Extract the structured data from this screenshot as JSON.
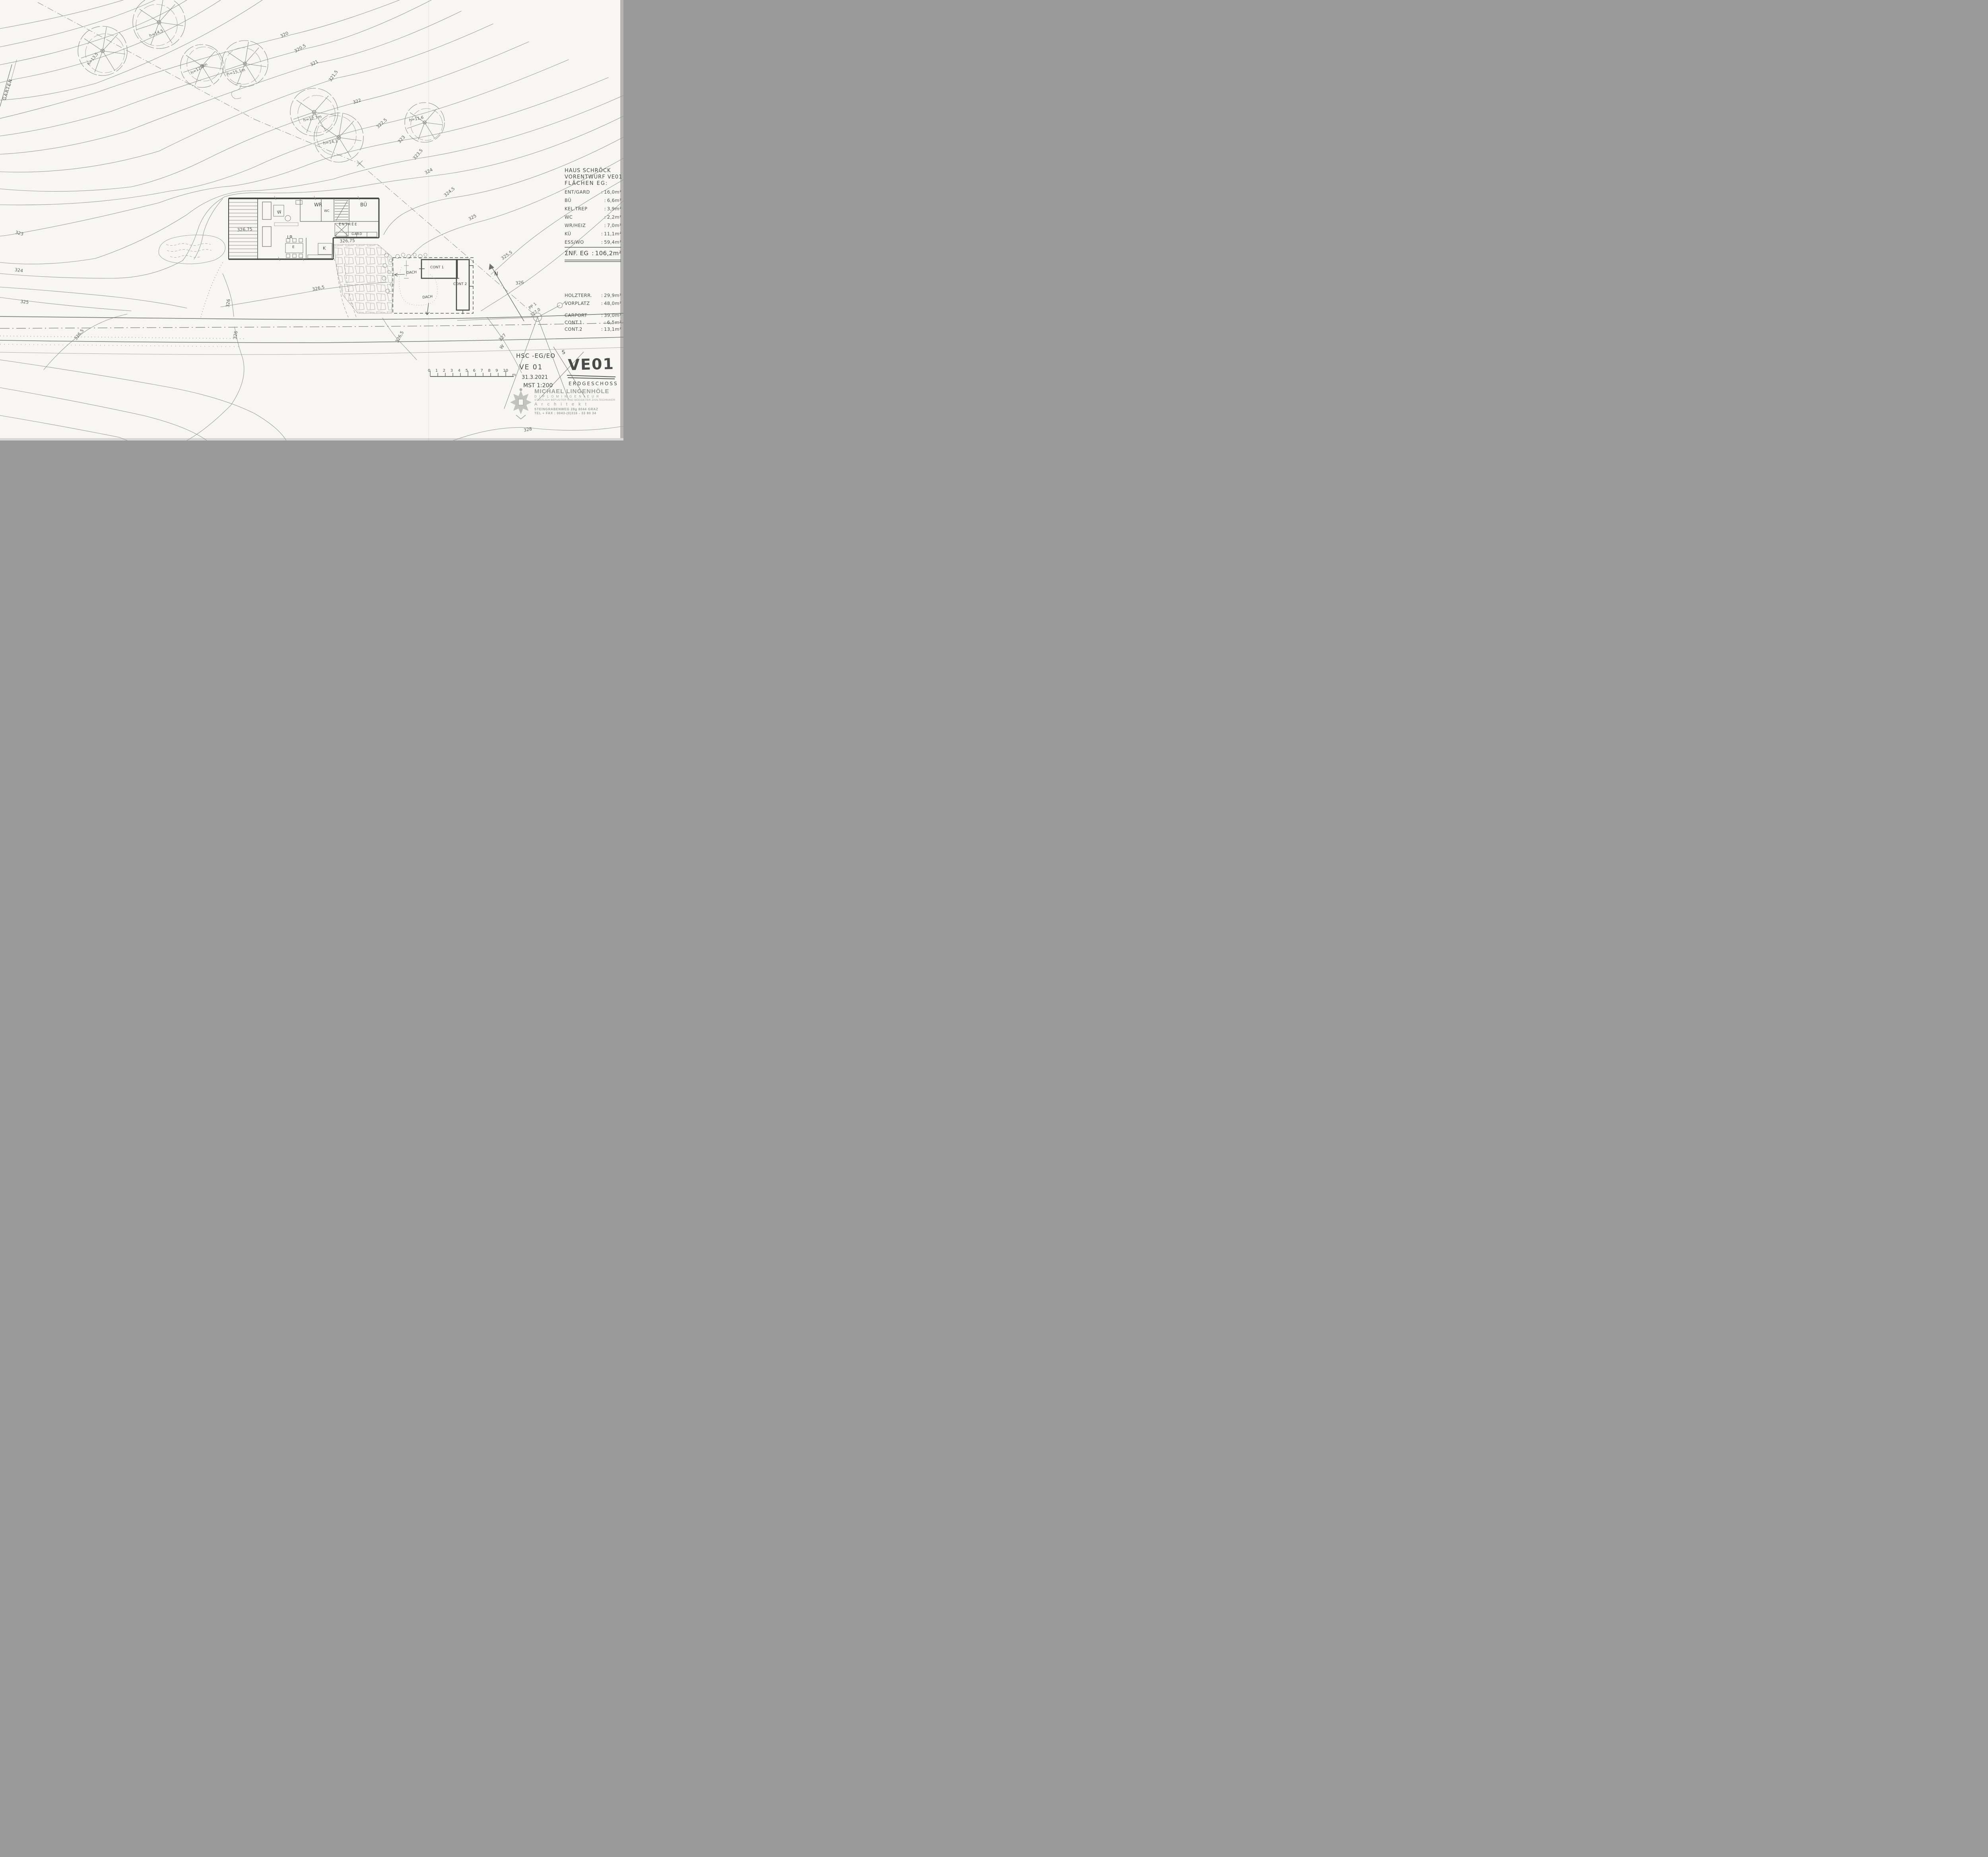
{
  "punct": {
    "colon": ":"
  },
  "sheet": {
    "garten_label": "GARTEN",
    "north_label": "N"
  },
  "area_table": {
    "title_line1": "HAUS SCHRÖCK",
    "title_line2": "VORENTWURF VE01",
    "title_line3": "FLÄCHEN EG:",
    "rows": [
      {
        "label": "ENT/GARD",
        "value": "16,0m²"
      },
      {
        "label": "BÜ",
        "value": "6,6m²"
      },
      {
        "label": "KEL.TREP",
        "value": "3,9m²"
      },
      {
        "label": "WC",
        "value": "2,2m²"
      },
      {
        "label": "WR/HEIZ",
        "value": "7,0m²"
      },
      {
        "label": "KÜ",
        "value": "11,1m²"
      },
      {
        "label": "ESS/WO",
        "value": "59,4m²"
      }
    ],
    "total_label": "ΣNF. EG",
    "total_value": "106,2m²"
  },
  "outdoor_table": {
    "rows": [
      {
        "label": "HOLZTERR.",
        "value": "29,9m²"
      },
      {
        "label": "VORPLATZ",
        "value": "48,0m²"
      },
      {
        "label": "CARPORT",
        "value": "39,0m²"
      },
      {
        "label": "CONT.1",
        "value": "6,5m²"
      },
      {
        "label": "CONT.2",
        "value": "13,1m²"
      }
    ]
  },
  "title_block": {
    "code": "HSC -EG/EO",
    "version": "VE 01",
    "date": "31.3.2021",
    "scale": "MST 1:200",
    "sheet_code": "VE01",
    "sheet_name": "ERDGESCHOSS",
    "stray_mark": "S"
  },
  "stamp": {
    "name": "MICHAEL LINGENHÖLE",
    "title": "D I P L O M I N G E N I E U R",
    "subtitle": "STAATLICH BEFUGTER UND BEEIDETER ZIVILTECHNIKER",
    "profession": "A r c h i t e k t",
    "address": "STEINGRABENWEG 28g   8044 GRAZ",
    "phone": "TEL + FAX : 0043-(0)316 - 33 80 34"
  },
  "scale_bar": {
    "ticks": [
      "0",
      "1",
      "2",
      "3",
      "4",
      "5",
      "6",
      "7",
      "8",
      "9",
      "10"
    ],
    "unit": "m"
  },
  "plan": {
    "wr": "WR",
    "wc": "WC",
    "bu": "BÜ",
    "entree": "ENTRÉE",
    "gard": "GARD",
    "lr": "LR",
    "e": "E",
    "k": "K",
    "w": "W",
    "deck_level": "326,75",
    "patio_level": "326,75",
    "dach1": "DACH",
    "dach2": "DACH",
    "cont1": "CONT 1",
    "cont2": "CONT 2"
  },
  "survey": {
    "pp": "PP 1",
    "pp_level": "327,0"
  },
  "trees": [
    "h=13,5",
    "h≈14,5",
    "h=12,3m",
    "h=15,1m",
    "h=12,7m",
    "h=14,1",
    "h=11,6"
  ],
  "contours": [
    "320",
    "320,5",
    "321",
    "321,5",
    "322",
    "322,5",
    "323",
    "323,5",
    "324",
    "324,5",
    "325",
    "325,5",
    "326",
    "323",
    "324",
    "325",
    "326",
    "326",
    "326,5",
    "326,5",
    "326,5",
    "327",
    "W",
    "328"
  ]
}
